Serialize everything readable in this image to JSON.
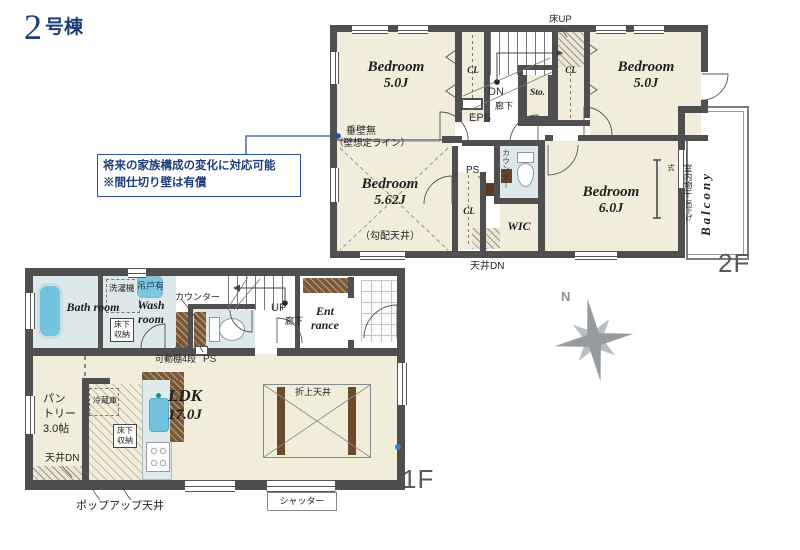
{
  "title": {
    "num": "2",
    "suffix": "号棟"
  },
  "note": {
    "line1": "将来の家族構成の変化に対応可能",
    "line2": "※間仕切り壁は有償"
  },
  "callout": {
    "main": "垂壁無",
    "sub": "（壁想定ライン）"
  },
  "compass": {
    "north": "N"
  },
  "f2": {
    "floor_label": "2F",
    "bedroom_nw_name": "Bedroom",
    "bedroom_nw_area": "5.0J",
    "bedroom_ne_name": "Bedroom",
    "bedroom_ne_area": "5.0J",
    "bedroom_sw_name": "Bedroom",
    "bedroom_sw_area": "5.62J",
    "bedroom_sw_note": "（勾配天井）",
    "bedroom_se_name": "Bedroom",
    "bedroom_se_area": "6.0J",
    "cl_nw": "CL",
    "cl_ne": "CL",
    "cl_sw": "CL",
    "sto": "Sto.",
    "dn": "DN",
    "hall": "廊下",
    "eps": "EPS",
    "floor_up": "床UP",
    "ps": "PS",
    "counter": "カウンター",
    "wic": "WIC",
    "ceiling_dn": "天井DN",
    "drying_main": "室内物干",
    "drying_sub": "吊下げ式",
    "balcony": "Balcony"
  },
  "f1": {
    "floor_label": "1F",
    "bath": "Bath room",
    "washer": "洗濯機",
    "hanging_cabinet": "吊戸有",
    "wash": "Wash room",
    "underfloor_storage_wash": "床下収納",
    "counter": "カウンター",
    "movable_shelf": "可動棚4段",
    "ps": "PS",
    "up": "UP",
    "hall": "廊下",
    "entrance": "Ent rance",
    "pantry_line1": "パン",
    "pantry_line2": "トリー",
    "pantry_line3": "3.0帖",
    "ceiling_dn": "天井DN",
    "fridge": "冷蔵庫",
    "underfloor_storage_kitchen": "床下収納",
    "ldk_name": "LDK",
    "ldk_area": "17.0J",
    "coffered_ceiling": "折上天井",
    "popup_ceiling": "ポップアップ天井",
    "shutter": "シャッター"
  },
  "colors": {
    "wall": "#4f4f4f",
    "room_cream": "#f2ecda",
    "wet_blue": "#dce8ea",
    "fixture_blue": "#72c3de",
    "wood_brown": "#7b5836",
    "navy": "#1e4b9e",
    "gray_label": "#5a5a5a"
  }
}
